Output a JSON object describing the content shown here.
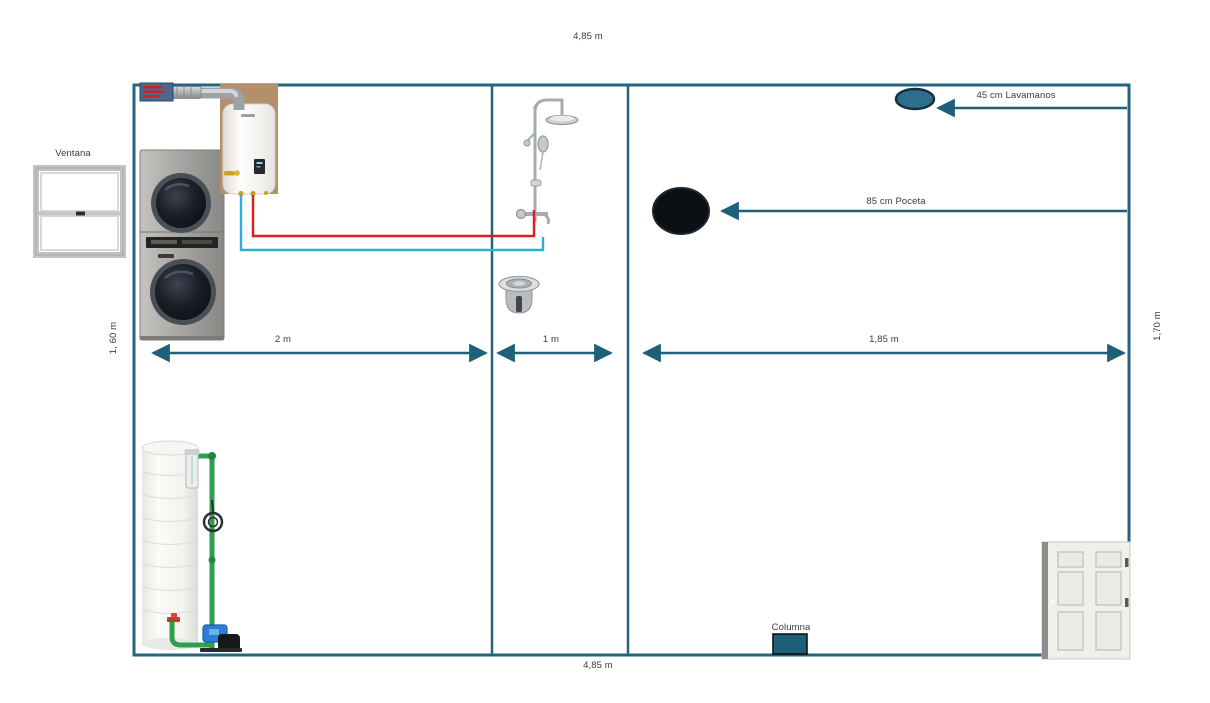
{
  "labels": {
    "width_top": "4,85 m",
    "width_bottom": "4,85 m",
    "height_left": "1, 60 m",
    "height_right": "1,70 m",
    "laundry_section_width": "2 m",
    "shower_section_width": "1 m",
    "bath_section_width": "1,85 m",
    "sink_offset": "45 cm Lavamanos",
    "toilet_offset": "85 cm Poceta",
    "window": "Ventana",
    "column": "Columna"
  },
  "colors": {
    "wall": "#26657f",
    "dimension_arrow": "#1d6078",
    "hot_water_pipe": "#e11a1a",
    "cold_water_pipe": "#2ab0d6",
    "tank_pipe_green": "#2f9e4f",
    "sink_fill": "#2d6e8e",
    "toilet_fill": "#0c1014",
    "column_fill": "#1d6078"
  },
  "fixtures": [
    "window",
    "washer-dryer-stack",
    "water-heater",
    "vent-pipe",
    "vent-grille",
    "shower-column",
    "floor-drain",
    "sink",
    "toilet",
    "water-tank",
    "water-pump",
    "column",
    "door"
  ]
}
